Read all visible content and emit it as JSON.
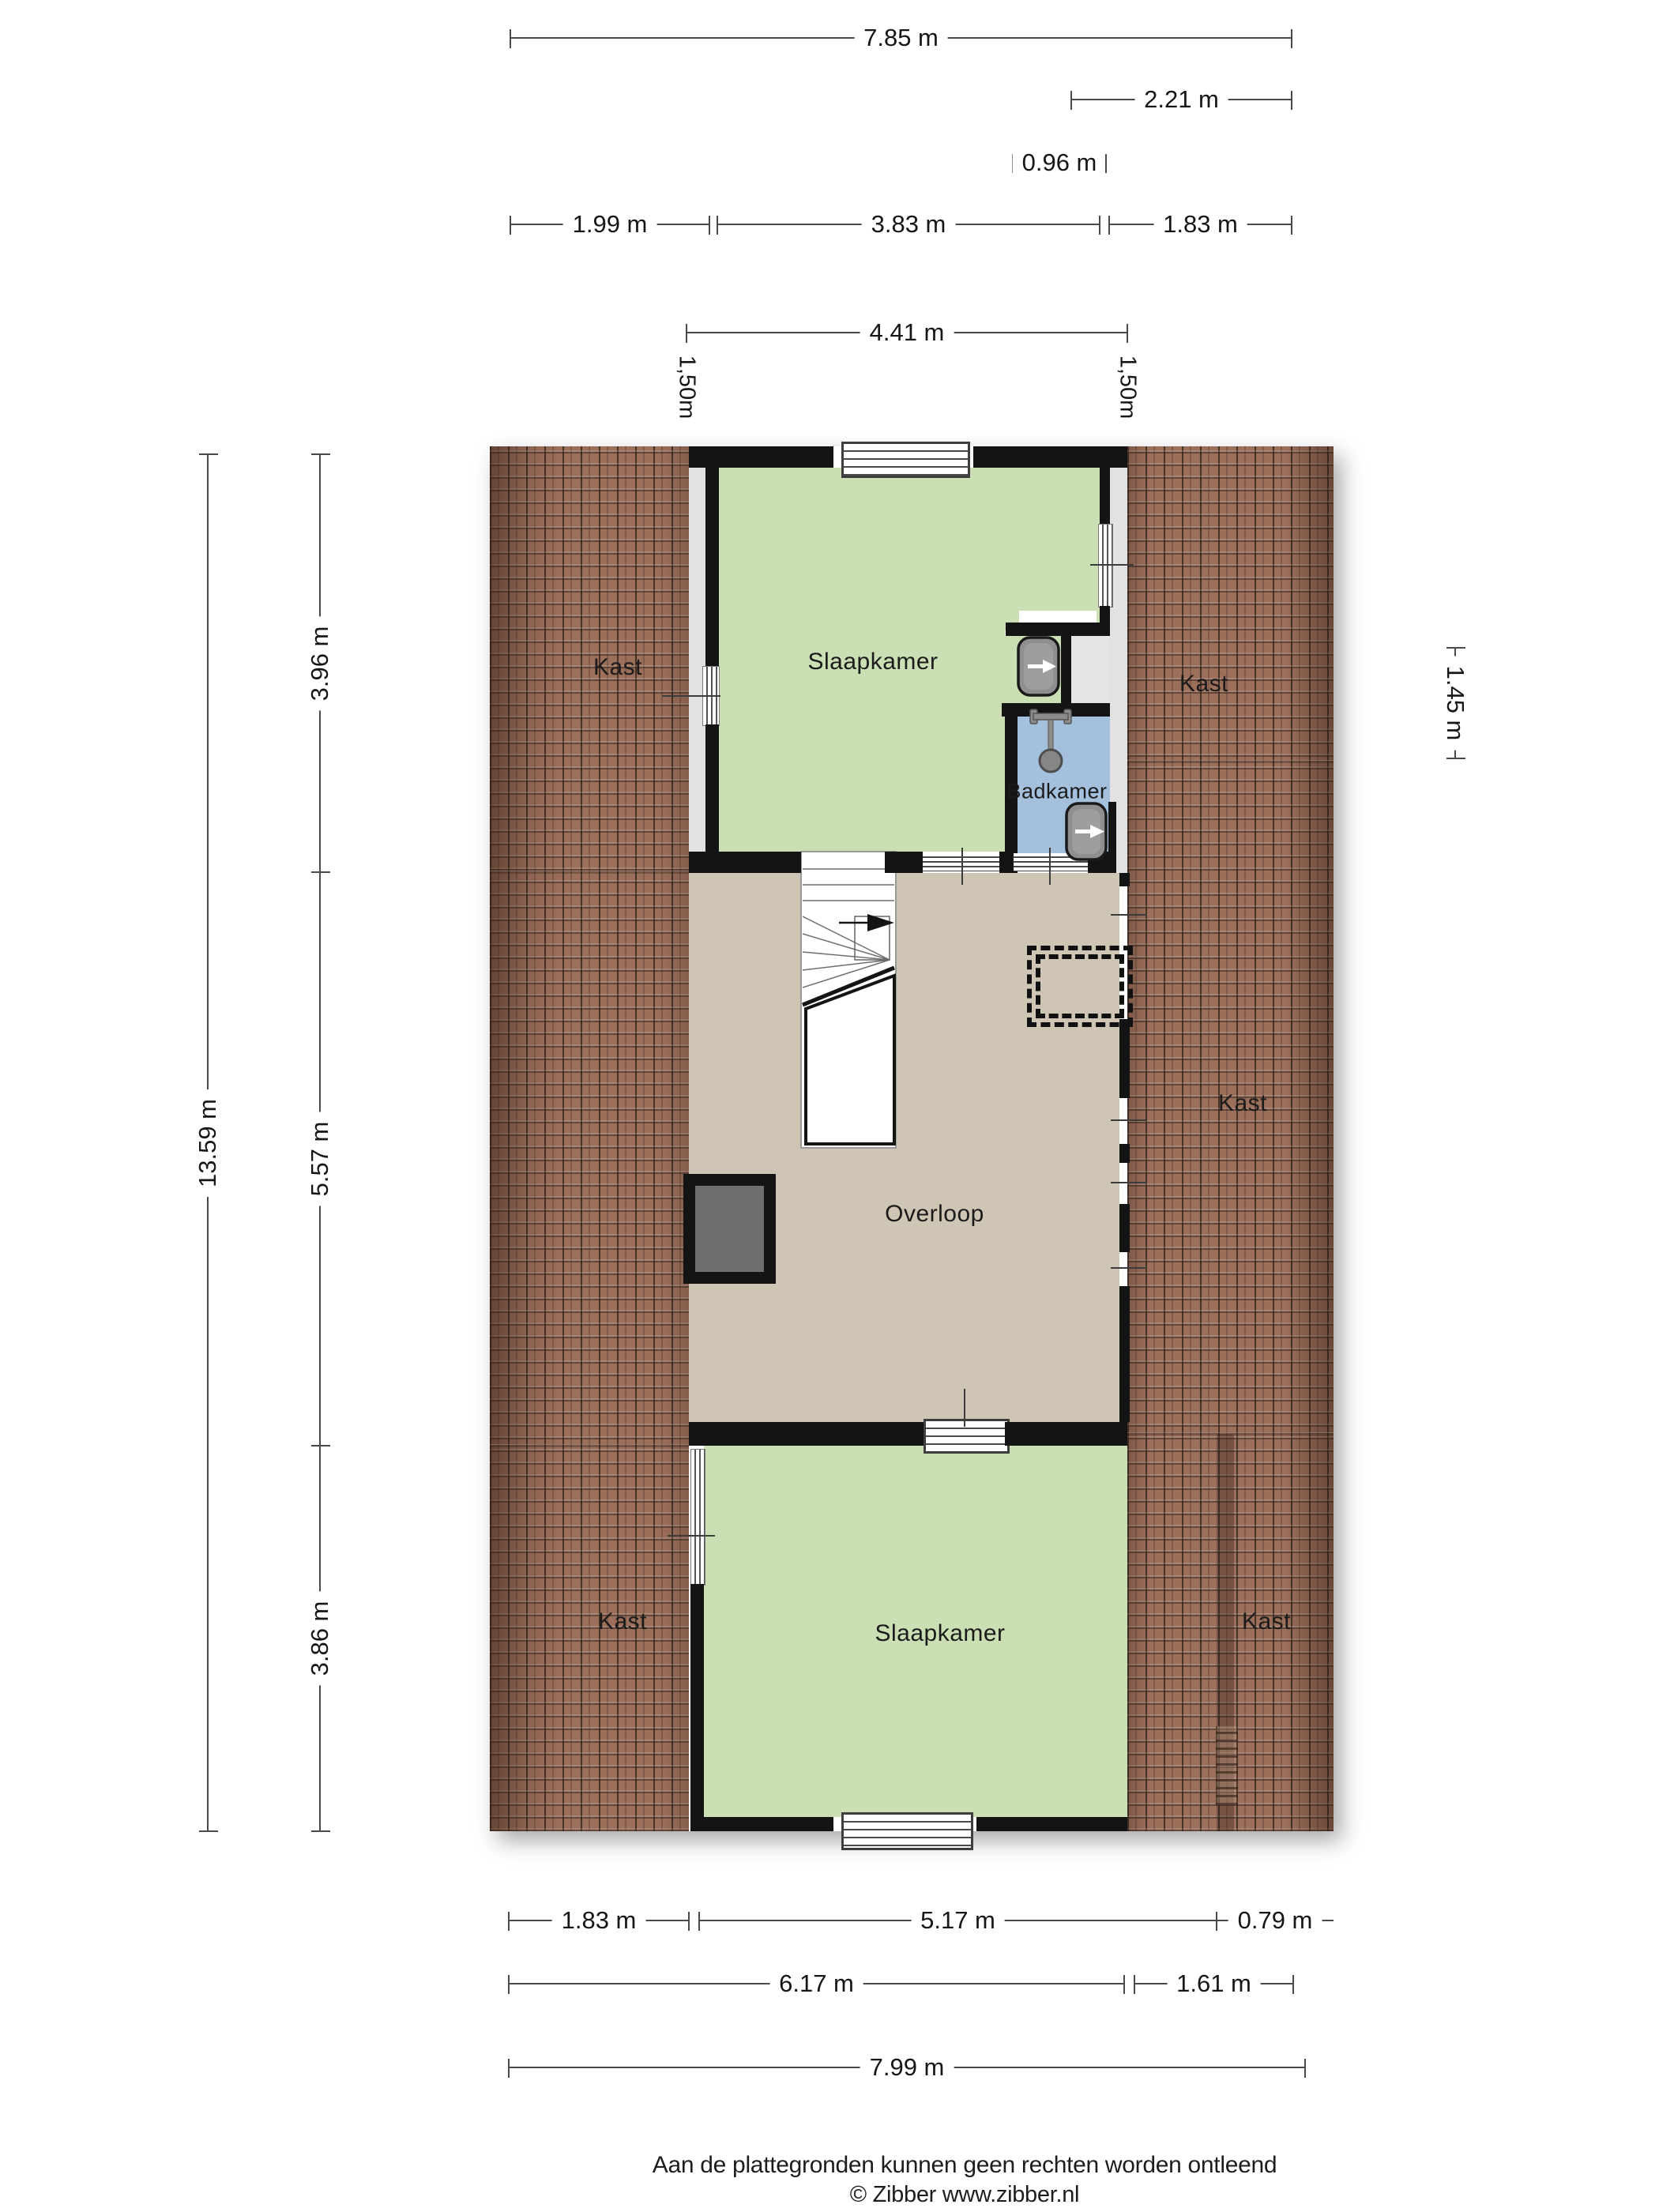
{
  "floorplan": {
    "rooms": [
      {
        "name": "kast-top-left",
        "label": "Kast"
      },
      {
        "name": "slaapkamer-top",
        "label": "Slaapkamer"
      },
      {
        "name": "kast-top-right",
        "label": "Kast"
      },
      {
        "name": "badkamer",
        "label": "Badkamer"
      },
      {
        "name": "kast-mid-right",
        "label": "Kast"
      },
      {
        "name": "overloop",
        "label": "Overloop"
      },
      {
        "name": "kast-bottom-left",
        "label": "Kast"
      },
      {
        "name": "slaapkamer-bottom",
        "label": "Slaapkamer"
      },
      {
        "name": "kast-bottom-right",
        "label": "Kast"
      }
    ],
    "colors": {
      "wall": "#141414",
      "room_green": "#cbdfb5",
      "floor_tan": "#cfc5b4",
      "bath_blue": "#a4c0dc",
      "roof_brown": "#9c6f5b",
      "side_gray": "#e2e2e2"
    }
  },
  "dimensions": {
    "top": [
      "7.85 m",
      "2.21 m",
      "0.96 m",
      "1.99 m",
      "3.83 m",
      "1.83 m",
      "4.41 m"
    ],
    "knee_walls": [
      "1,50m",
      "1,50m"
    ],
    "left": [
      "13.59 m",
      "3.96 m",
      "5.57 m",
      "3.86 m"
    ],
    "right": [
      "1.45 m"
    ],
    "bottom": [
      "1.83 m",
      "5.17 m",
      "0.79 m",
      "6.17 m",
      "1.61 m",
      "7.99 m"
    ]
  },
  "footer": {
    "disclaimer": "Aan de plattegronden kunnen geen rechten worden ontleend",
    "credit": "© Zibber www.zibber.nl"
  }
}
